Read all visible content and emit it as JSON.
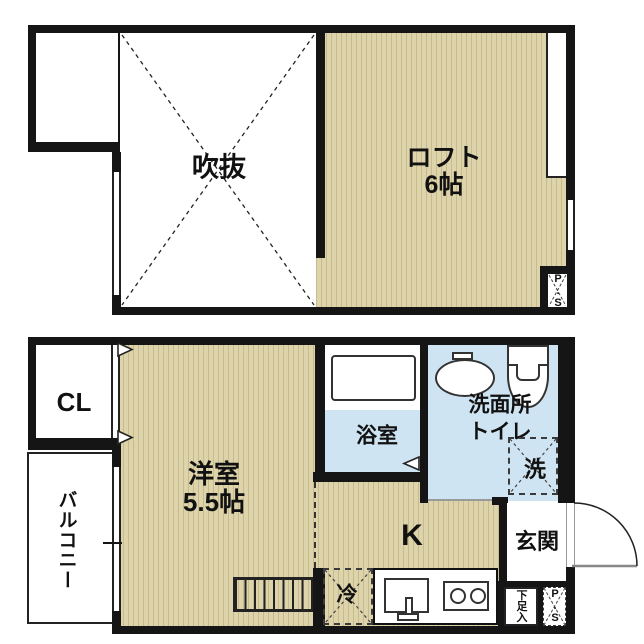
{
  "upper": {
    "void_label": "吹抜",
    "loft_name": "ロフト",
    "loft_size": "6帖",
    "ps_label": "P.S"
  },
  "lower": {
    "closet_label": "CL",
    "balcony_label": "バルコニー",
    "room_name": "洋室",
    "room_size": "5.5帖",
    "bath_label": "浴室",
    "washroom_label": "洗面所",
    "toilet_label": "トイレ",
    "washer_label": "洗",
    "kitchen_label": "K",
    "fridge_label": "冷",
    "entrance_label": "玄関",
    "shoe_box_label": "下足入",
    "ps_label": "P.S"
  },
  "colors": {
    "tatami_base": "#ddd4ab",
    "tatami_stripe": "#c7bb8d",
    "wet_area": "#cfe4f2",
    "wall": "#151515"
  }
}
